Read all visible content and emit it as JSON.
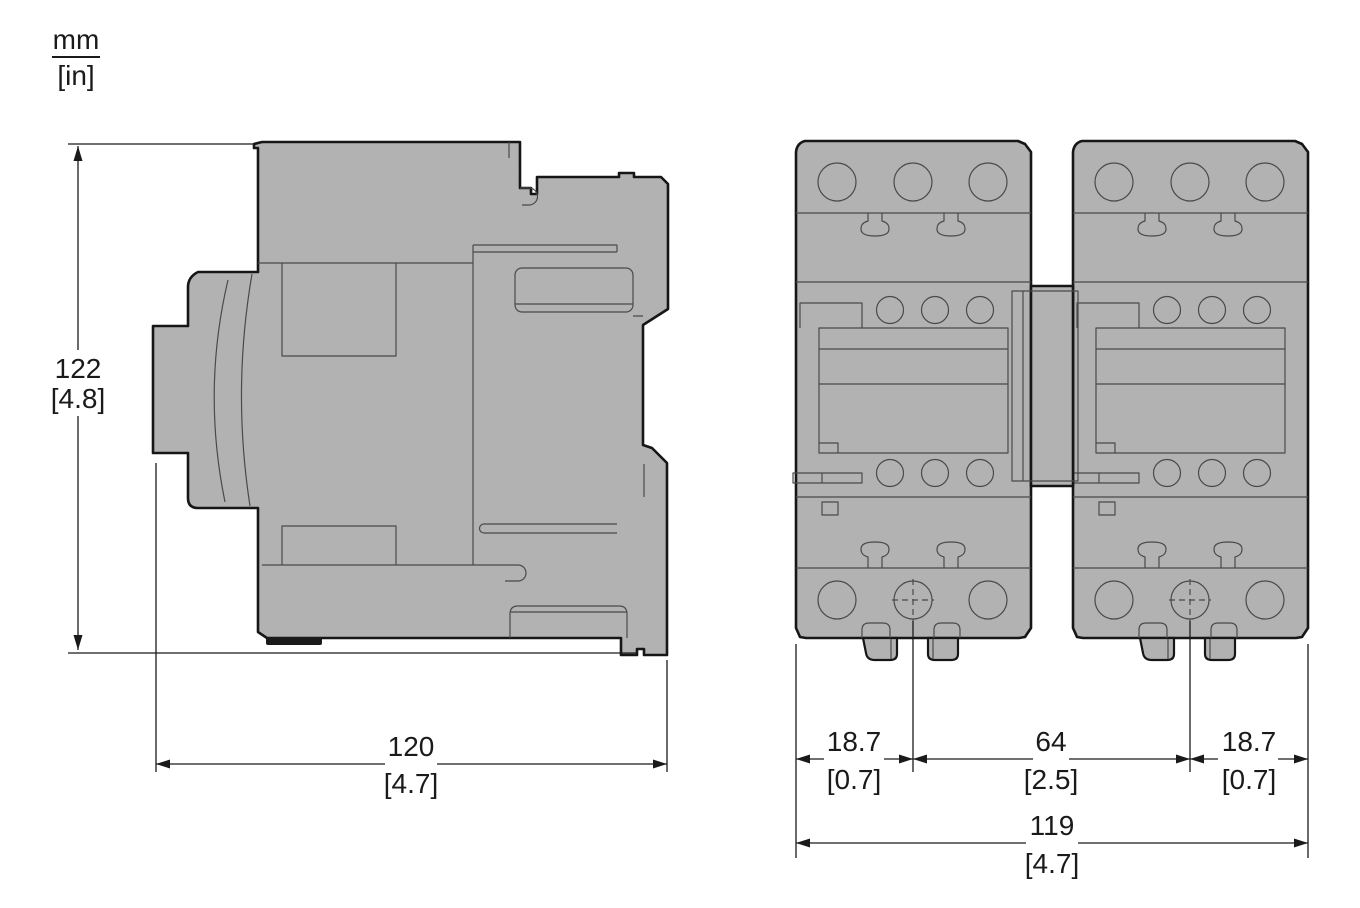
{
  "drawing": {
    "kind": "contactor-dimension-drawing",
    "views": [
      "side-view",
      "front-view-two-units"
    ]
  },
  "units": {
    "mm": "mm",
    "in": "[in]"
  },
  "side_view": {
    "height_mm": "122",
    "height_in": "[4.8]",
    "width_mm": "120",
    "width_in": "[4.7]"
  },
  "front_view": {
    "left_offset_mm": "18.7",
    "left_offset_in": "[0.7]",
    "center_spacing_mm": "64",
    "center_spacing_in": "[2.5]",
    "right_offset_mm": "18.7",
    "right_offset_in": "[0.7]",
    "overall_width_mm": "119",
    "overall_width_in": "[4.7]"
  },
  "colors": {
    "body_fill": "#b2b2b2",
    "outline": "#161616",
    "detail_line": "#4a4a4a",
    "dimension_line": "#1a1a1a",
    "background": "#ffffff"
  }
}
